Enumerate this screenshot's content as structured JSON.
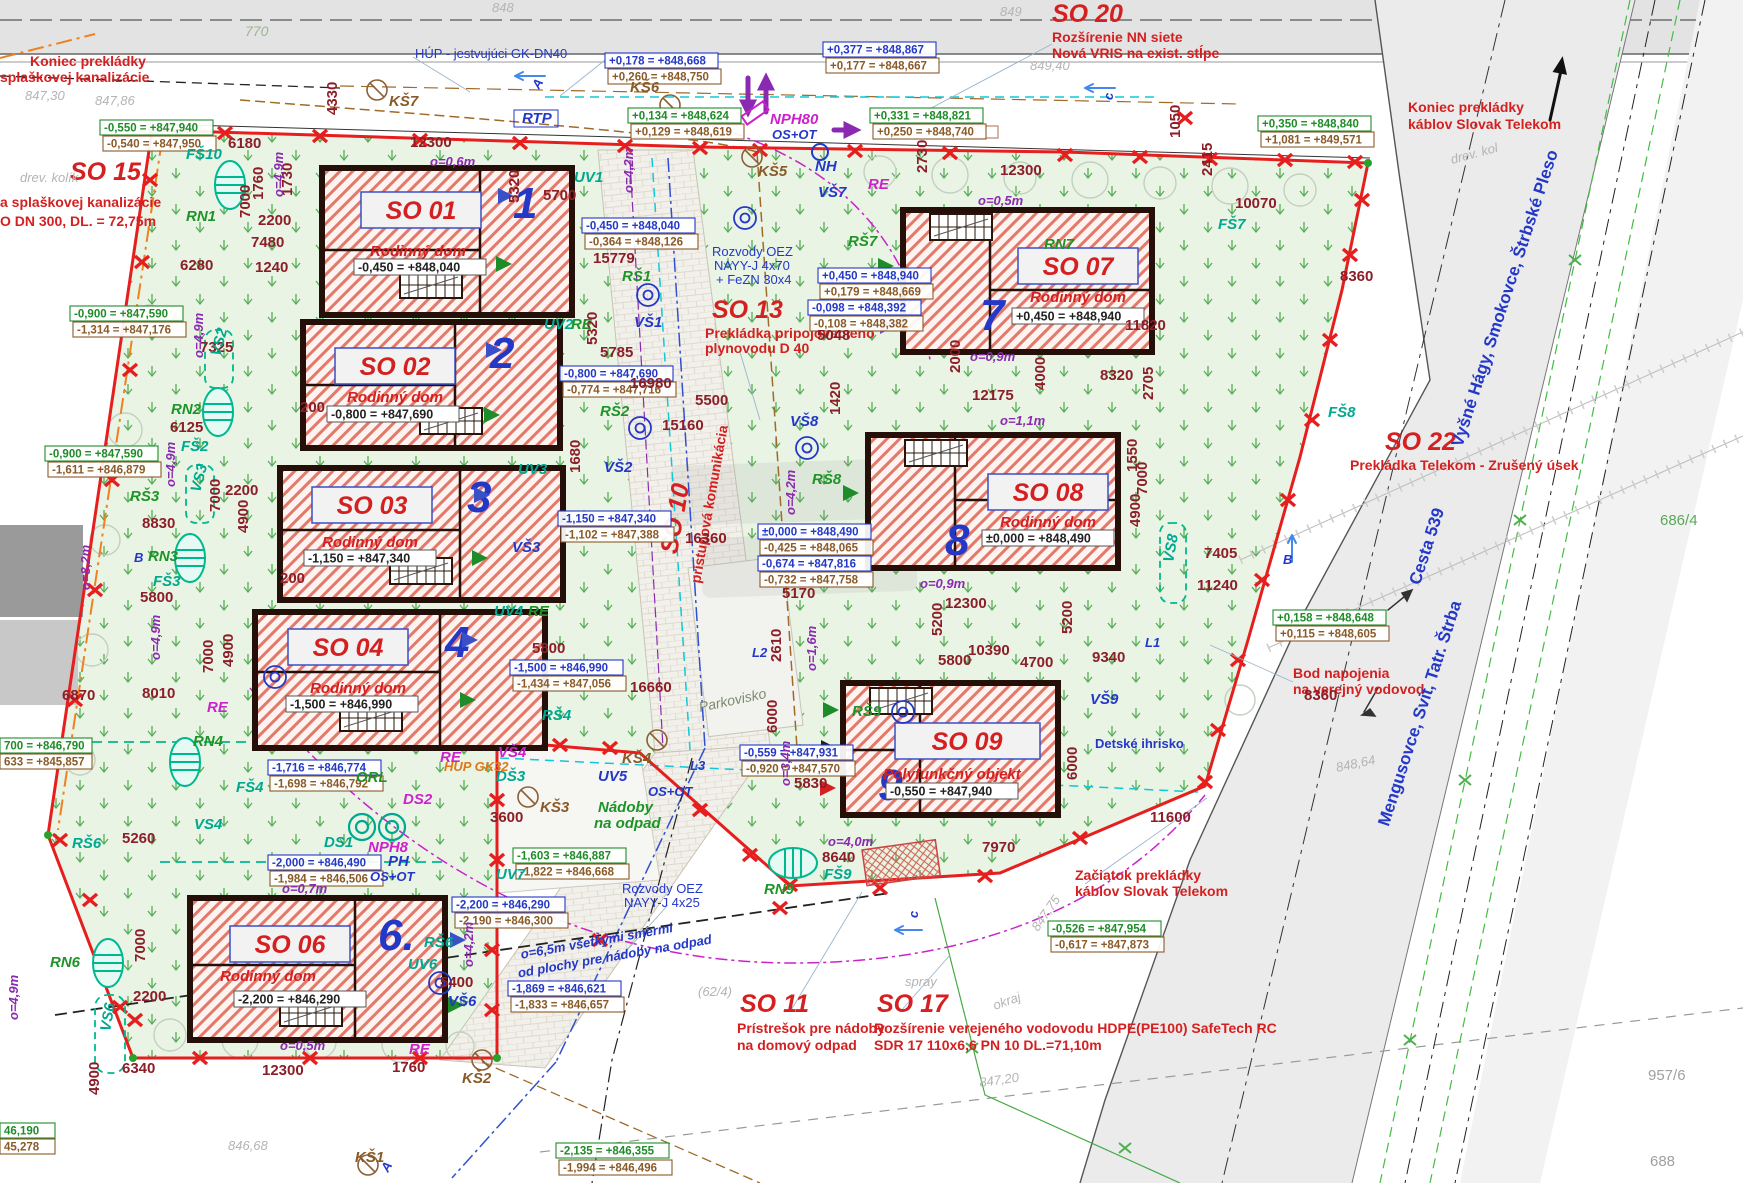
{
  "drawing_type": "site plan / zastavovacia situácia",
  "colors": {
    "boundary_red": "#e61e1e",
    "building_hatch": "#e2796a",
    "grass_green": "#3f9f3f",
    "dim_maroon": "#8c1e28",
    "label_blue": "#2438c8",
    "label_red": "#d42020",
    "teal": "#00a890",
    "magenta": "#cc22cc",
    "brown": "#8a5a28"
  },
  "icons": {
    "survey_x": "✕",
    "manhole_circle": "◯",
    "flow_arrow": "←",
    "north_arrow": "↑"
  },
  "buildings": [
    {
      "id": "SO 01",
      "num": "1",
      "type": "Rodinný dom",
      "elev": "-0,450 = +848,040"
    },
    {
      "id": "SO 02",
      "num": "2",
      "type": "Rodinný dom",
      "elev": "-0,800 = +847,690"
    },
    {
      "id": "SO 03",
      "num": "3",
      "type": "Rodinný dom",
      "elev": "-1,150 = +847,340"
    },
    {
      "id": "SO 04",
      "num": "4",
      "type": "Rodinný dom",
      "elev": "-1,500 = +846,990"
    },
    {
      "id": "SO 06",
      "num": "6.",
      "type": "Rodinný dom",
      "elev": "-2,200 = +846,290"
    },
    {
      "id": "SO 07",
      "num": "7",
      "type": "Rodinný dom",
      "elev": "+0,450 = +848,940"
    },
    {
      "id": "SO 08",
      "num": "8",
      "type": "Rodinný dom",
      "elev": "±0,000 = +848,490"
    },
    {
      "id": "SO 09",
      "num": "9.",
      "type": "Polyfunkčný objekt",
      "elev": "-0,550 = +847,940"
    }
  ],
  "annotations": {
    "so15": {
      "id": "SO 15",
      "l1": "a splaškovej kanalizácie",
      "l2": "O DN 300, DL. = 72,75m"
    },
    "so20": {
      "id": "SO 20",
      "l1": "Rozšírenie NN siete",
      "l2": "Nová VRIS na exist. stĺpe"
    },
    "so22": {
      "id": "SO 22",
      "l1": "Prekládka Telekom - Zrušený úsek"
    },
    "so13": {
      "id": "SO 13",
      "l1": "Prekládka pripojovacieho",
      "l2": "plynovodu D 40"
    },
    "so10": {
      "id": "SO 10",
      "l1": "prístupová komunikácia"
    },
    "so11": {
      "id": "SO 11",
      "l1": "Prístrešok pre nádoby",
      "l2": "na domový odpad"
    },
    "so17": {
      "id": "SO 17",
      "l1": "Rozšírenie verejeného vodovodu HDPE(PE100) SafeTech RC",
      "l2": "SDR 17 110x6,6 PN 10 DL.=71,10m"
    },
    "koniec_kanalizacie": {
      "l1": "Koniec prekládky",
      "l2": "splaškovej kanalizácie"
    },
    "koniec_telekom": {
      "l1": "Koniec prekládky",
      "l2": "káblov Slovak Telekom"
    },
    "zaciatok_telekom": {
      "l1": "Začiatok prekládky",
      "l2": "káblov Slovak Telekom"
    },
    "bod_napojenia": {
      "l1": "Bod napojenia",
      "l2": "na verejný vodovod"
    },
    "hup": "HÚP - jestvujúci GK-DN40",
    "rozvody_70": {
      "l1": "Rozvody OEZ",
      "l2": "NAYY-J 4x70",
      "l3": "+ FeZN 30x4"
    },
    "rozvody_25": {
      "l1": "Rozvody OEZ",
      "l2": "NAYY-J 4x25"
    },
    "odpad_note": {
      "l1": "o=6,5m všetkými smermi",
      "l2": "od plochy pre nádoby na odpad"
    },
    "nadoby": {
      "l1": "Nádoby",
      "l2": "na odpad"
    },
    "parkovisko": "Parkovisko",
    "ihrisko": "Detské ihrisko"
  },
  "roads": {
    "dir_north": "Vyšné Hágy, Smokovce, Štrbské Pleso",
    "dir_south": "Mengusovce, Svit, Tatr. Štrba",
    "cesta": "Cesta 539"
  },
  "parcels": {
    "p1": "686/4",
    "p2": "957/6",
    "p3": "688"
  },
  "codes": [
    "KŠ7",
    "KŠ6",
    "KŠ5",
    "KŠ4",
    "KŠ3",
    "KŠ2",
    "KŠ1",
    "RŠ1",
    "RŠ2",
    "RŠ4",
    "RŠ6",
    "RŠ6",
    "RŠ7",
    "RŠ8",
    "RŠ9",
    "VŠ1",
    "VŠ2",
    "VŠ3",
    "VŠ4",
    "VŠ6",
    "VŠ7",
    "VŠ8",
    "VŠ9",
    "UV1",
    "UV2",
    "UV3",
    "UV4",
    "UV5",
    "UV6",
    "UV7",
    "RN1",
    "RN2",
    "RN3",
    "RN4",
    "RN6",
    "RN7",
    "RN9",
    "FŠ10",
    "FŠ2",
    "FŠ3",
    "FŠ4",
    "FŠ7",
    "FŠ8",
    "FŠ9",
    "ORL",
    "DS1",
    "DS2",
    "DŠ3",
    "NPH80",
    "OS+OT",
    "NPH8",
    "PH",
    "OS+OT",
    "OS+OT",
    "NH",
    "RTP",
    "RE",
    "RE",
    "RE",
    "RE",
    "RE",
    "RE",
    "L1",
    "L2",
    "L3",
    "VS2",
    "VS3",
    "VS4",
    "VS6",
    "VS8",
    "B",
    "B",
    "c",
    "c",
    "A",
    "A",
    "HUP GK32",
    "RŠ3"
  ],
  "dims": [
    "12300",
    "6180",
    "4330",
    "1730",
    "1760",
    "7000",
    "2200",
    "7480",
    "6280",
    "1240",
    "7325",
    "6125",
    "8830",
    "5800",
    "8010",
    "6870",
    "5260",
    "7000",
    "4900",
    "6340",
    "12300",
    "1760",
    "2200",
    "15779",
    "5320",
    "5700",
    "5320",
    "5785",
    "16980",
    "15160",
    "5500",
    "16360",
    "16660",
    "5800",
    "3600",
    "12300",
    "2730",
    "1050",
    "2415",
    "10070",
    "12175",
    "2000",
    "4000",
    "11820",
    "8320",
    "8360",
    "1420",
    "2705",
    "1550",
    "7000",
    "4900",
    "12300",
    "5200",
    "5200",
    "5170",
    "10390",
    "4700",
    "9340",
    "5800",
    "2610",
    "6000",
    "6000",
    "5830",
    "8360",
    "11600",
    "7970",
    "8640",
    "7405",
    "11240",
    "5400",
    "5048",
    "1680",
    "2200",
    "4900",
    "7000",
    "4900",
    "7000",
    "200",
    "200"
  ],
  "elevations": [
    "+0,178 = +848,668",
    "+0,260 = +848,750",
    "+0,377 = +848,867",
    "+0,177 = +848,667",
    "+0,134 = +848,624",
    "+0,129 = +848,619",
    "+0,331 = +848,821",
    "+0,250 = +848,740",
    "+0,350 = +848,840",
    "+1,081 = +849,571",
    "-0,450 = +848,040",
    "-0,364 = +848,126",
    "-0,800 = +847,690",
    "-0,774 = +847,716",
    "-1,150 = +847,340",
    "-1,102 = +847,388",
    "-1,500 = +846,990",
    "-1,434 = +847,056",
    "+0,450 = +848,940",
    "+0,179 = +848,669",
    "-0,098 = +848,392",
    "-0,108 = +848,382",
    "±0,000 = +848,490",
    "-0,425 = +848,065",
    "-0,674 = +847,816",
    "-0,732 = +847,758",
    "-0,559 = +847,931",
    "-0,920 = +847,570",
    "-0,550 = +847,940",
    "-0,540 = +847,950",
    "-0,900 = +847,590",
    "-1,314 = +847,176",
    "-0,900 = +847,590",
    "-1,611 = +846,879",
    "700 = +846,790",
    "633 = +845,857",
    "-1,716 = +846,774",
    "-1,698 = +846,792",
    "-2,000 = +846,490",
    "-1,984 = +846,506",
    "-2,200 = +846,290",
    "-2,190 = +846,300",
    "-1,603 = +846,887",
    "-1,822 = +846,668",
    "-1,869 = +846,621",
    "-1,833 = +846,657",
    "-2,135 = +846,355",
    "-1,994 = +846,496",
    "46,190",
    "45,278",
    "-0,526 = +847,954",
    "-0,617 = +847,873",
    "+0,158 = +848,648",
    "+0,115 = +848,605"
  ],
  "offsets": [
    "o=0,6m",
    "o=0,5m",
    "o=0,9m",
    "o=1,1m",
    "o=0,9m",
    "o=4,2m",
    "o=4,2m",
    "o=4,9m",
    "o=4,9m",
    "o=4,9m",
    "o=4,9m",
    "o=4,9m",
    "o=8,2m",
    "o=1,6m",
    "o=3,4m",
    "o=4,0m",
    "o=0,7m",
    "o=0,5m",
    "o=4,2m"
  ],
  "contours": [
    "770",
    "849",
    "849,40",
    "847,30",
    "847,86",
    "848",
    "848,64",
    "847,75",
    "847,20",
    "846,68",
    "spray",
    "okraj",
    "(62/4)",
    "drev. kolík",
    "drev. kol"
  ]
}
